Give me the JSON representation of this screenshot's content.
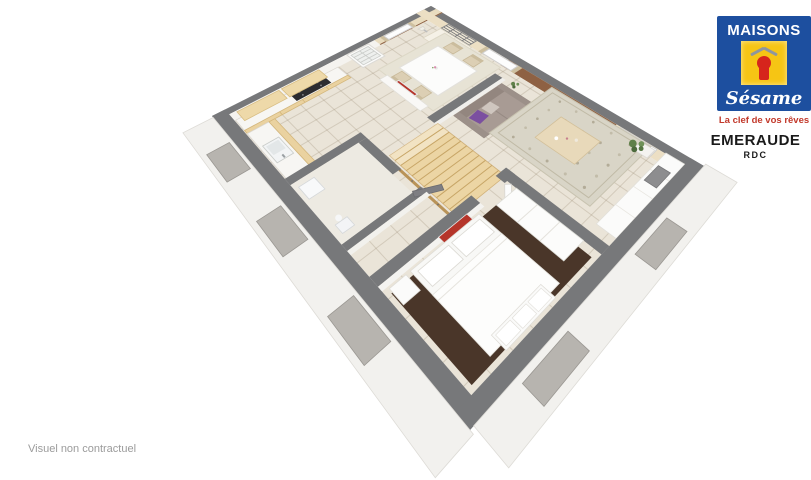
{
  "branding": {
    "logo_title": "MAISONS",
    "logo_script": "Sésame",
    "tagline": "La clef de vos rêves",
    "colors": {
      "blue": "#1d4f9f",
      "yellow": "#f6c514",
      "red": "#d6251c",
      "tagline_red": "#c2392b"
    }
  },
  "model": {
    "name": "EMERAUDE",
    "level": "RDC"
  },
  "footer": {
    "disclaimer": "Visuel non contractuel"
  },
  "floorplan": {
    "wall_top_color": "#77787a",
    "floor_color": "#eae4d8",
    "tile_line_color": "rgba(150,138,112,0.28)",
    "wall_face_white": "#f5f3ef",
    "wall_face_cream": "#ecdfc4",
    "accent_wall_color": "#8e6143",
    "wood_color": "#ead2a0",
    "stairs_color": "#ecd5a4",
    "sofa_color": "#a89b94",
    "sofa_cushion_purple": "#7b4fa0",
    "bedroom_rug_color": "#4a3629",
    "living_rug_color": "#d9d5c7",
    "curtain_color": "#cdbf9f",
    "art_red": "#b5352a",
    "plant_green": "#5f8049",
    "rooms": [
      "kitchen",
      "dining-area",
      "living-room",
      "bedroom",
      "hallway",
      "wc",
      "staircase"
    ]
  }
}
